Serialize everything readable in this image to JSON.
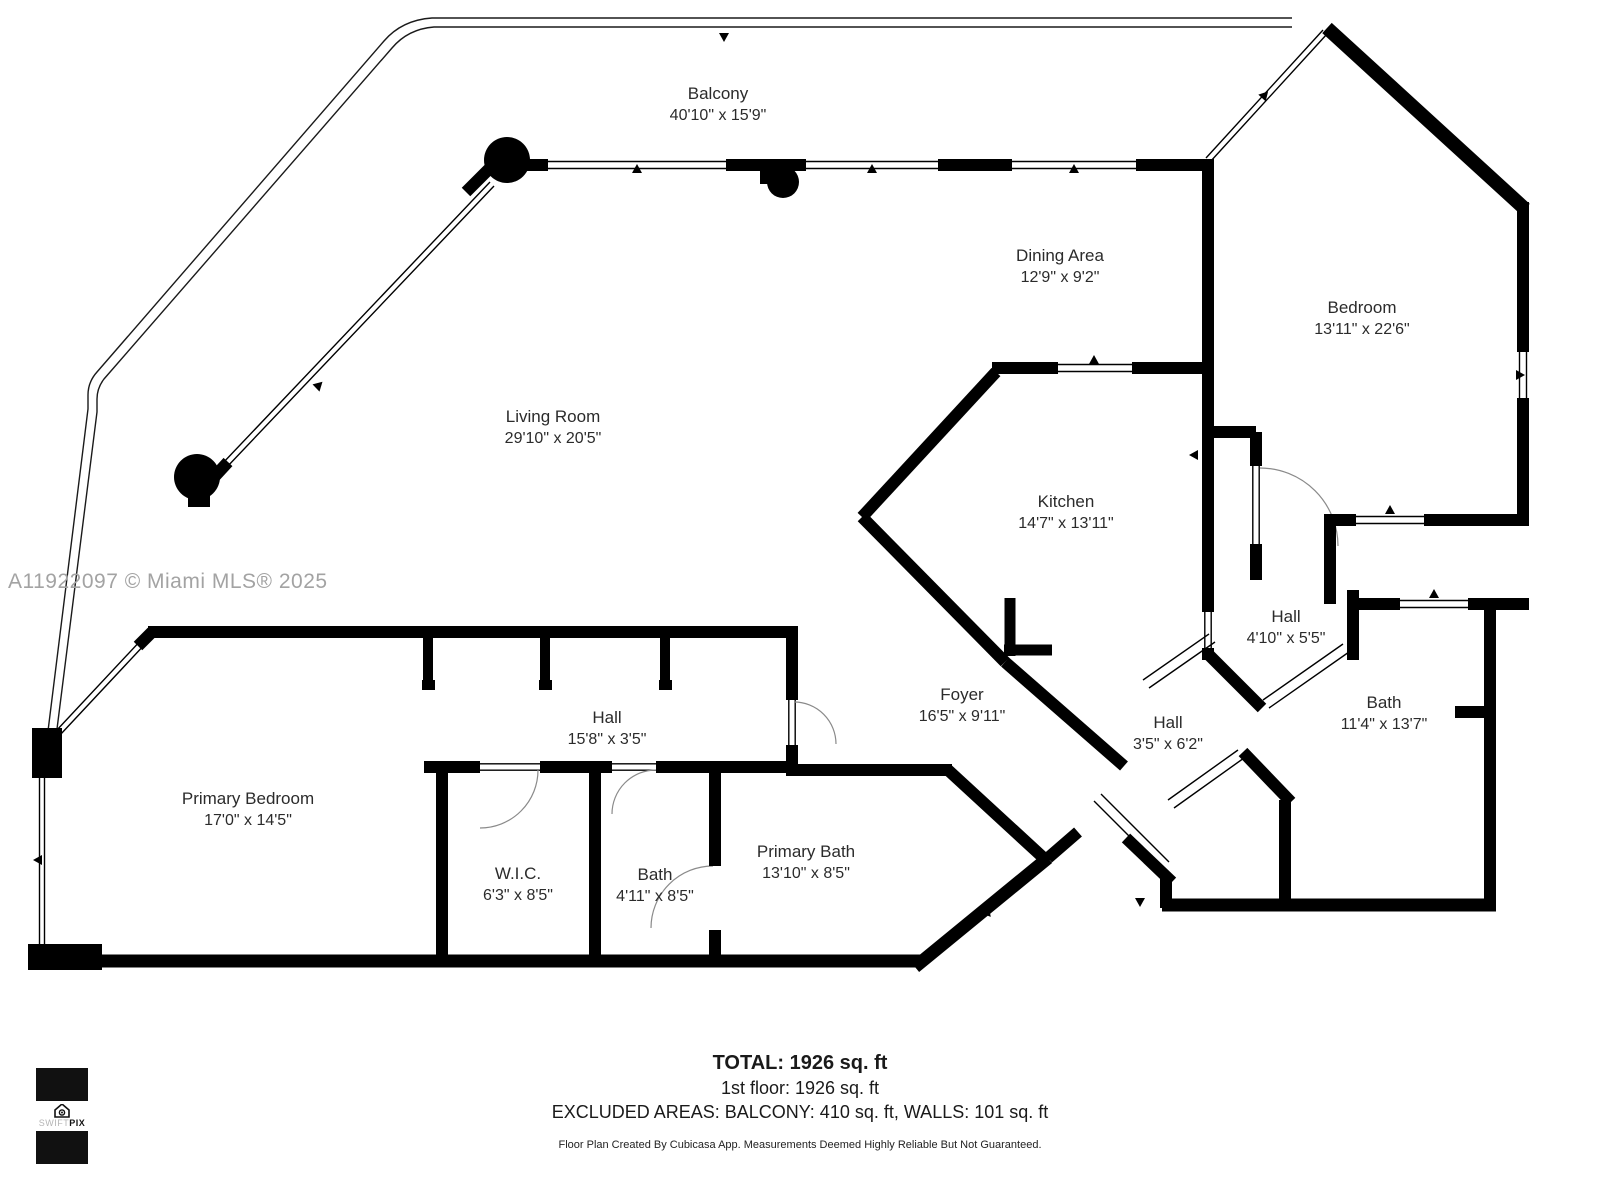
{
  "watermark": "A11922097 © Miami MLS® 2025",
  "rooms": [
    {
      "name": "Balcony",
      "dims": "40'10\" x 15'9\"",
      "x": 718,
      "y": 83
    },
    {
      "name": "Dining Area",
      "dims": "12'9\" x 9'2\"",
      "x": 1060,
      "y": 245
    },
    {
      "name": "Bedroom",
      "dims": "13'11\" x 22'6\"",
      "x": 1362,
      "y": 297
    },
    {
      "name": "Living Room",
      "dims": "29'10\" x 20'5\"",
      "x": 553,
      "y": 406
    },
    {
      "name": "Kitchen",
      "dims": "14'7\" x 13'11\"",
      "x": 1066,
      "y": 491
    },
    {
      "name": "Hall",
      "dims": "4'10\" x 5'5\"",
      "x": 1286,
      "y": 606
    },
    {
      "name": "Foyer",
      "dims": "16'5\" x 9'11\"",
      "x": 962,
      "y": 684
    },
    {
      "name": "Hall",
      "dims": "3'5\" x 6'2\"",
      "x": 1168,
      "y": 712
    },
    {
      "name": "Bath",
      "dims": "11'4\" x 13'7\"",
      "x": 1384,
      "y": 692
    },
    {
      "name": "Hall",
      "dims": "15'8\" x 3'5\"",
      "x": 607,
      "y": 707
    },
    {
      "name": "Primary Bedroom",
      "dims": "17'0\" x 14'5\"",
      "x": 248,
      "y": 788
    },
    {
      "name": "W.I.C.",
      "dims": "6'3\" x 8'5\"",
      "x": 518,
      "y": 863
    },
    {
      "name": "Bath",
      "dims": "4'11\" x 8'5\"",
      "x": 655,
      "y": 864
    },
    {
      "name": "Primary Bath",
      "dims": "13'10\" x 8'5\"",
      "x": 806,
      "y": 841
    }
  ],
  "summary": {
    "total": "TOTAL: 1926 sq. ft",
    "floor1": "1st floor: 1926 sq. ft",
    "excluded": "EXCLUDED AREAS: BALCONY: 410 sq. ft, WALLS: 101 sq. ft",
    "disclaimer": "Floor Plan Created By Cubicasa App. Measurements Deemed Highly Reliable But Not Guaranteed."
  },
  "logo": {
    "brand_light": "SWIFT",
    "brand_bold": "PIX"
  },
  "colors": {
    "wall": "#000000",
    "label": "#2b2b2b",
    "watermark": "#a3a3a3"
  }
}
